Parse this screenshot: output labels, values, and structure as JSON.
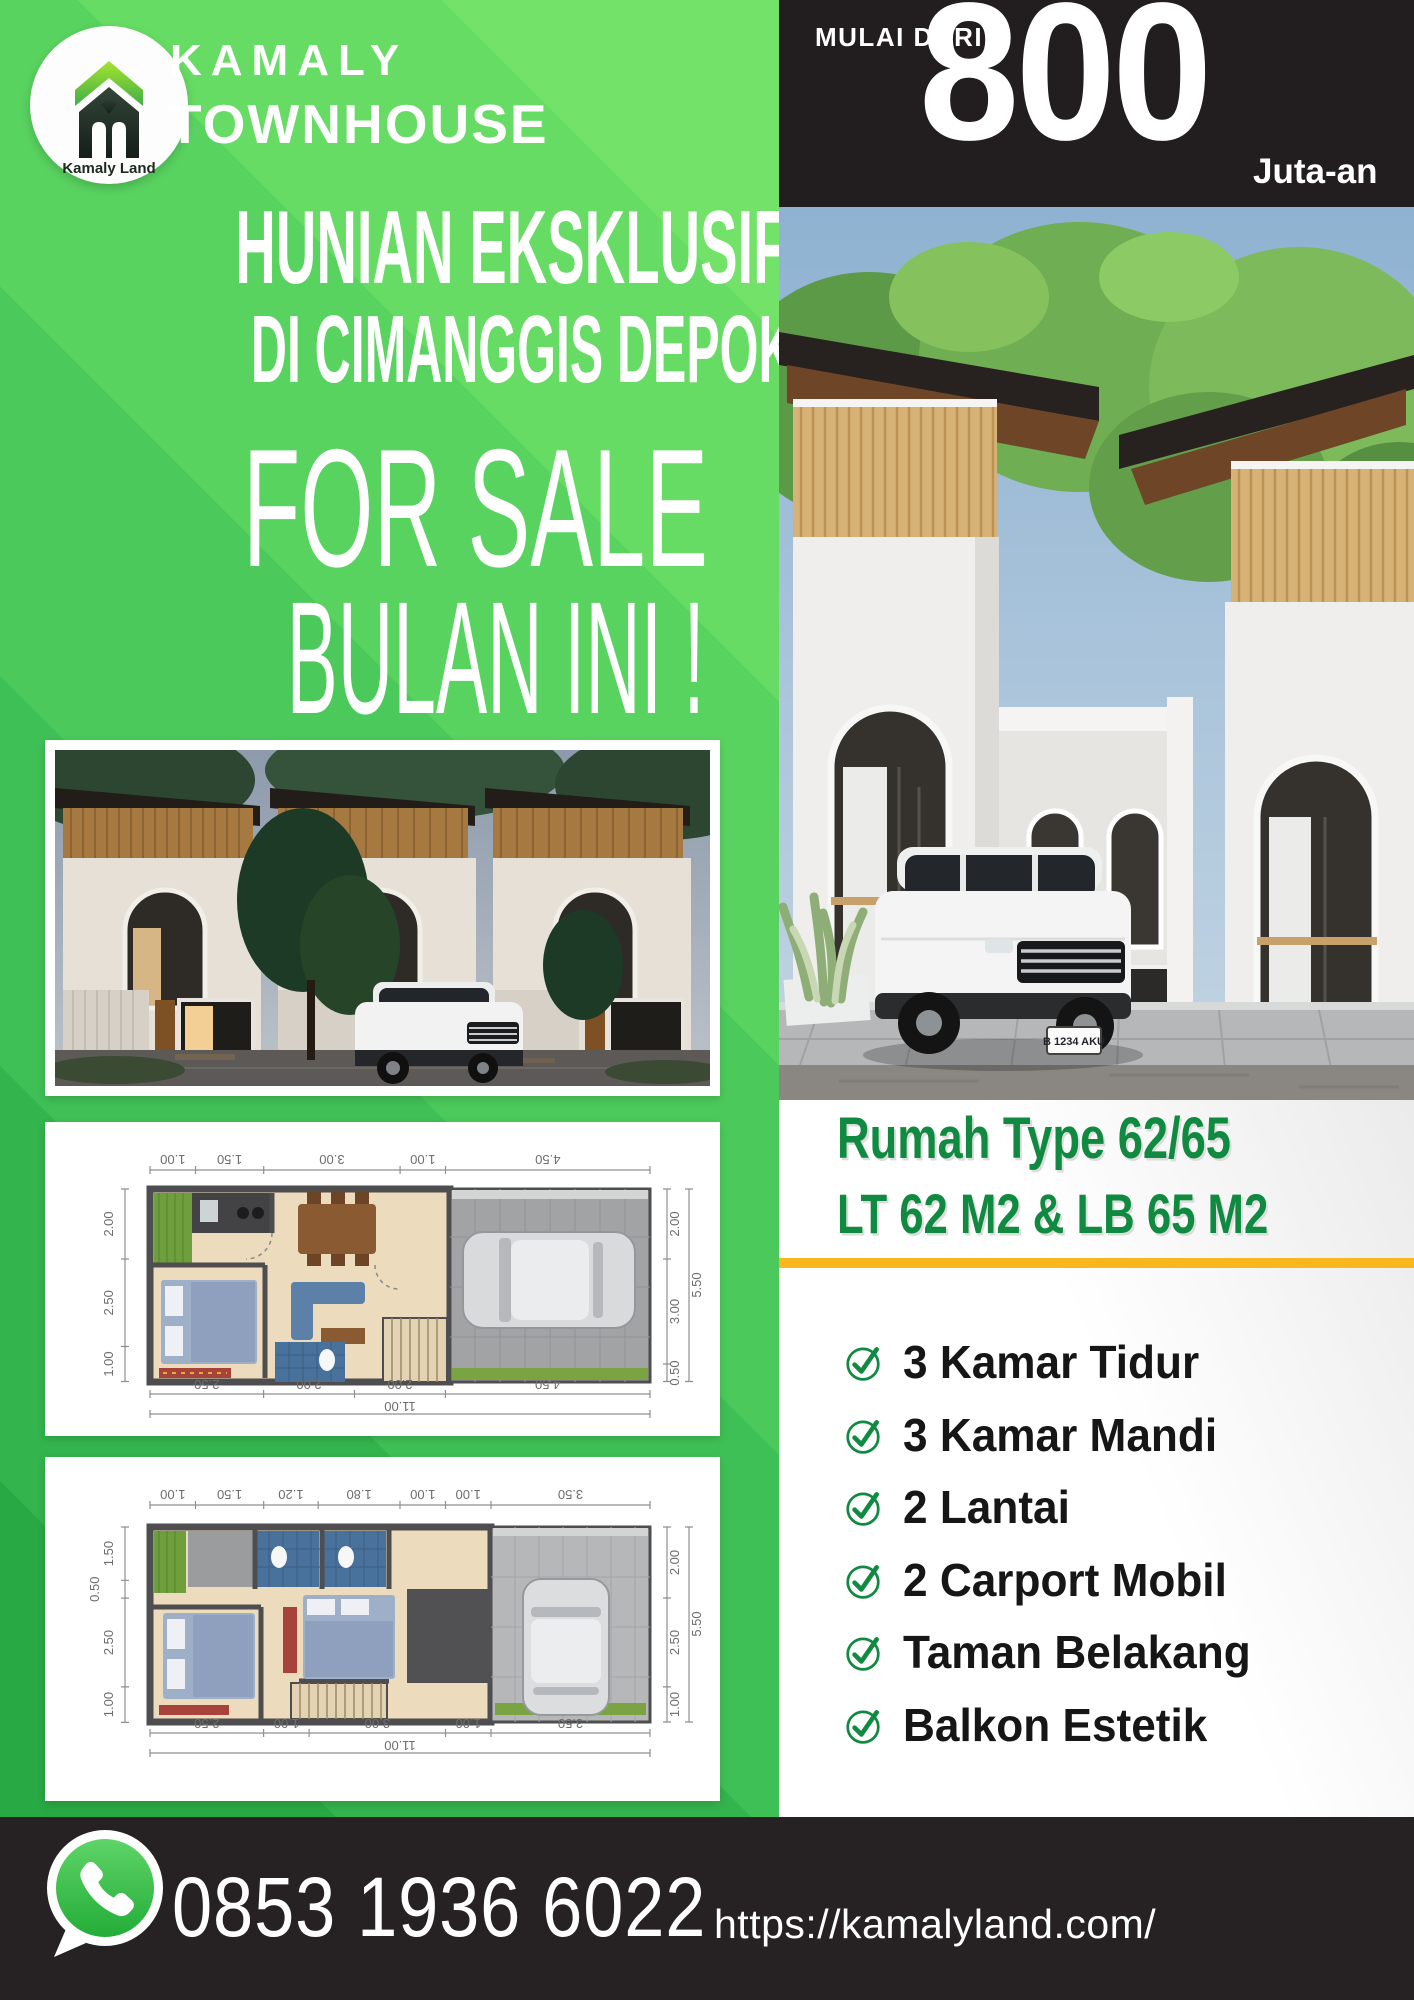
{
  "brand": {
    "name": "KAMALY",
    "product": "TOWNHOUSE",
    "logo_caption": "Kamaly Land"
  },
  "price": {
    "prefix": "MULAI DARI",
    "amount": "800",
    "suffix": "Juta-an"
  },
  "headline": {
    "line1": "HUNIAN EKSKLUSIF",
    "line2": "DI CIMANGGIS DEPOK",
    "line3": "FOR SALE",
    "line4": "BULAN INI !"
  },
  "spec": {
    "line1": "Rumah Type 62/65",
    "line2": "LT 62 M2 & LB 65 M2"
  },
  "features": [
    "3 Kamar Tidur",
    "3 Kamar Mandi",
    "2 Lantai",
    "2 Carport Mobil",
    "Taman Belakang",
    "Balkon Estetik"
  ],
  "contact": {
    "phone": "0853 1936 6022",
    "website": "https://kamalyland.com/"
  },
  "photo": {
    "license_plate": "B 1234 AKU"
  },
  "plan1": {
    "top": [
      "1.00",
      "1.50",
      "3.00",
      "1.00",
      "4.50"
    ],
    "bottom": [
      "2.50",
      "2.00",
      "2.00",
      "4.50"
    ],
    "bottom_total": "11.00",
    "left": [
      "2.00",
      "2.50",
      "1.00"
    ],
    "right": [
      "2.00",
      "3.00",
      "0.50"
    ],
    "right_total": "5.50"
  },
  "plan2": {
    "top": [
      "1.00",
      "1.50",
      "1.20",
      "1.80",
      "1.00",
      "1.00",
      "3.50"
    ],
    "bottom": [
      "2.50",
      "1.00",
      "3.00",
      "1.00",
      "3.50"
    ],
    "bottom_total": "11.00",
    "left": [
      "1.50",
      "0.50",
      "2.50",
      "1.00"
    ],
    "right": [
      "2.00",
      "2.50",
      "1.00"
    ],
    "right_total": "5.50"
  },
  "colors": {
    "green_dark": "#108a40",
    "green_base": "#3fc256",
    "green_light": "#73e269",
    "yellow": "#f8b71c",
    "panel_black": "#221d1e",
    "footer_black": "#262122",
    "whatsapp_green": "#2fb840"
  }
}
